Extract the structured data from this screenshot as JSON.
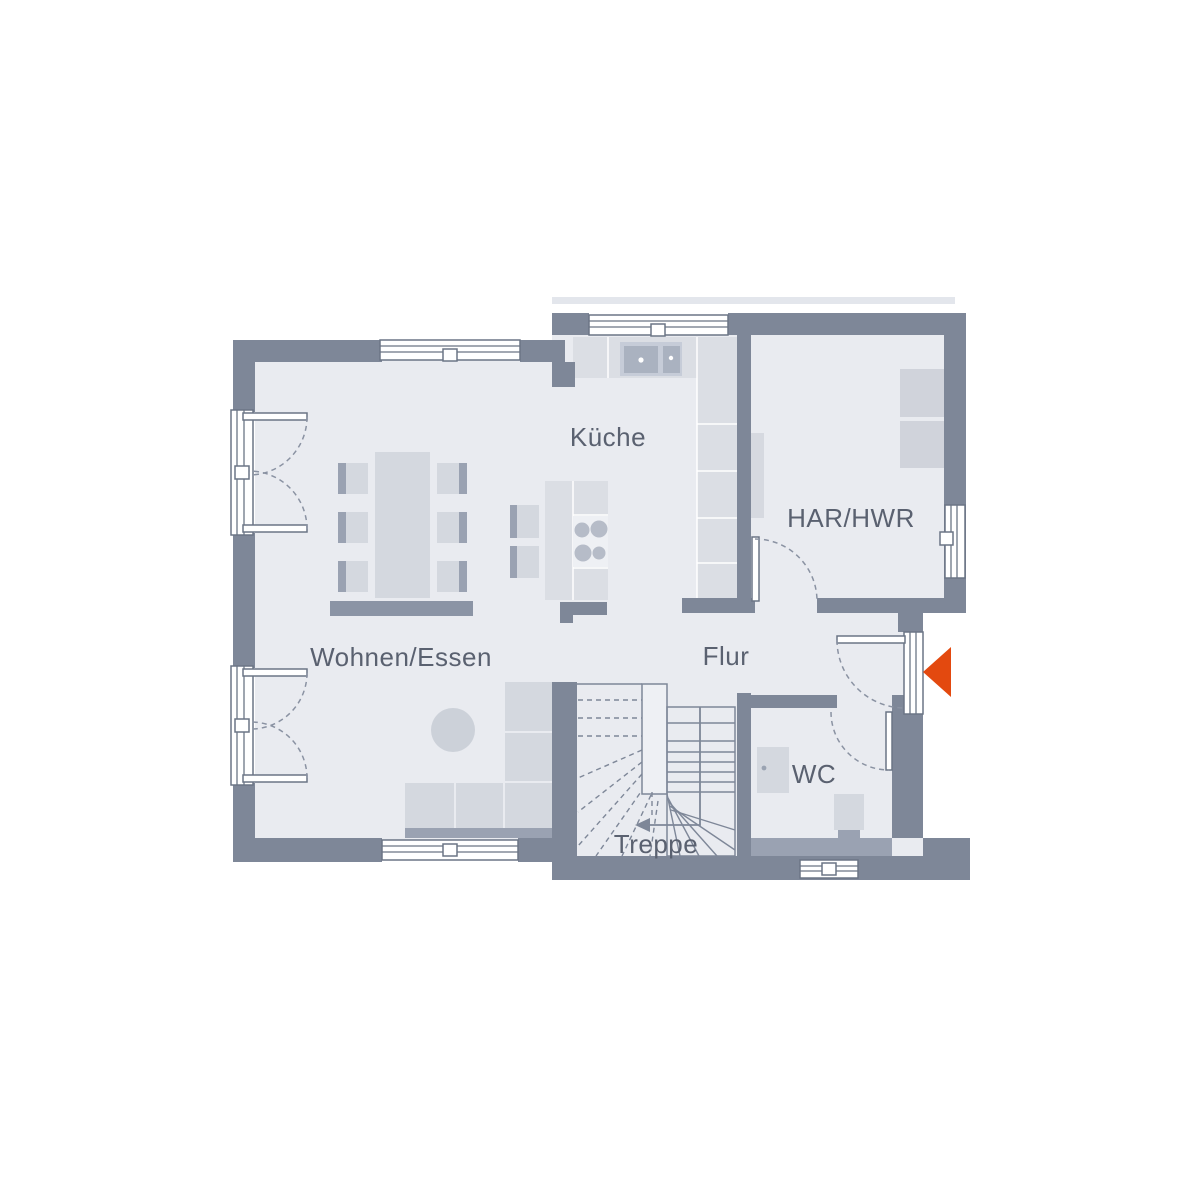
{
  "plan": {
    "type": "floor-plan",
    "rooms": [
      {
        "label": "Wohnen/Essen"
      },
      {
        "label": "Küche"
      },
      {
        "label": "Flur"
      },
      {
        "label": "HAR/HWR"
      },
      {
        "label": "WC"
      },
      {
        "label": "Treppe"
      }
    ],
    "entrance_marker": {
      "shape": "triangle",
      "direction": "left",
      "color": "#e3490f"
    },
    "colors": {
      "wall": "#7e8798",
      "floor": "#e9ebf0",
      "furniture": "#d4d8df",
      "furniture_dark": "#9aa2b2",
      "counter": "#dbdee4",
      "window": "#ffffff",
      "text": "#5a6170",
      "accent": "#e3490f"
    }
  }
}
